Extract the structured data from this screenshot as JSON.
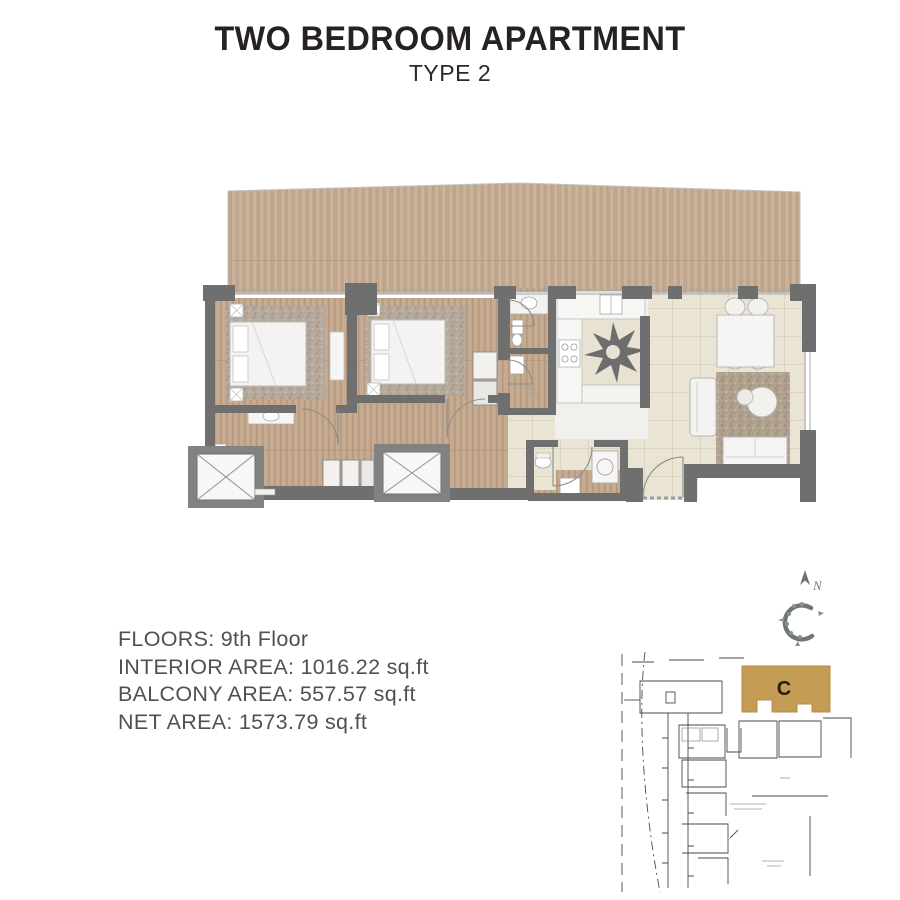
{
  "header": {
    "title": "TWO BEDROOM APARTMENT",
    "subtitle": "TYPE 2"
  },
  "details": {
    "lines": [
      "FLOORS: 9th Floor",
      "INTERIOR AREA: 1016.22 sq.ft",
      "BALCONY AREA: 557.57 sq.ft",
      "NET AREA: 1573.79 sq.ft"
    ]
  },
  "compass": {
    "north_label": "N"
  },
  "site_map": {
    "highlighted_building_label": "C",
    "highlight_color": "#c59c55"
  },
  "floor_plan": {
    "type": "apartment-floor-plan",
    "rooms": [
      "balcony",
      "bedroom-1",
      "bedroom-2",
      "ensuite-bathroom",
      "bathroom-2",
      "bathroom-3",
      "guest-bathroom",
      "corridor",
      "kitchen",
      "living-dining-room",
      "entrance",
      "elevator-1",
      "elevator-2"
    ],
    "colors": {
      "wall": "#6f6f6f",
      "balcony_wood": "#c9b098",
      "interior_wood": "#c3a98f",
      "tile": "#e9e4d3",
      "rug": "#b2a595"
    }
  }
}
